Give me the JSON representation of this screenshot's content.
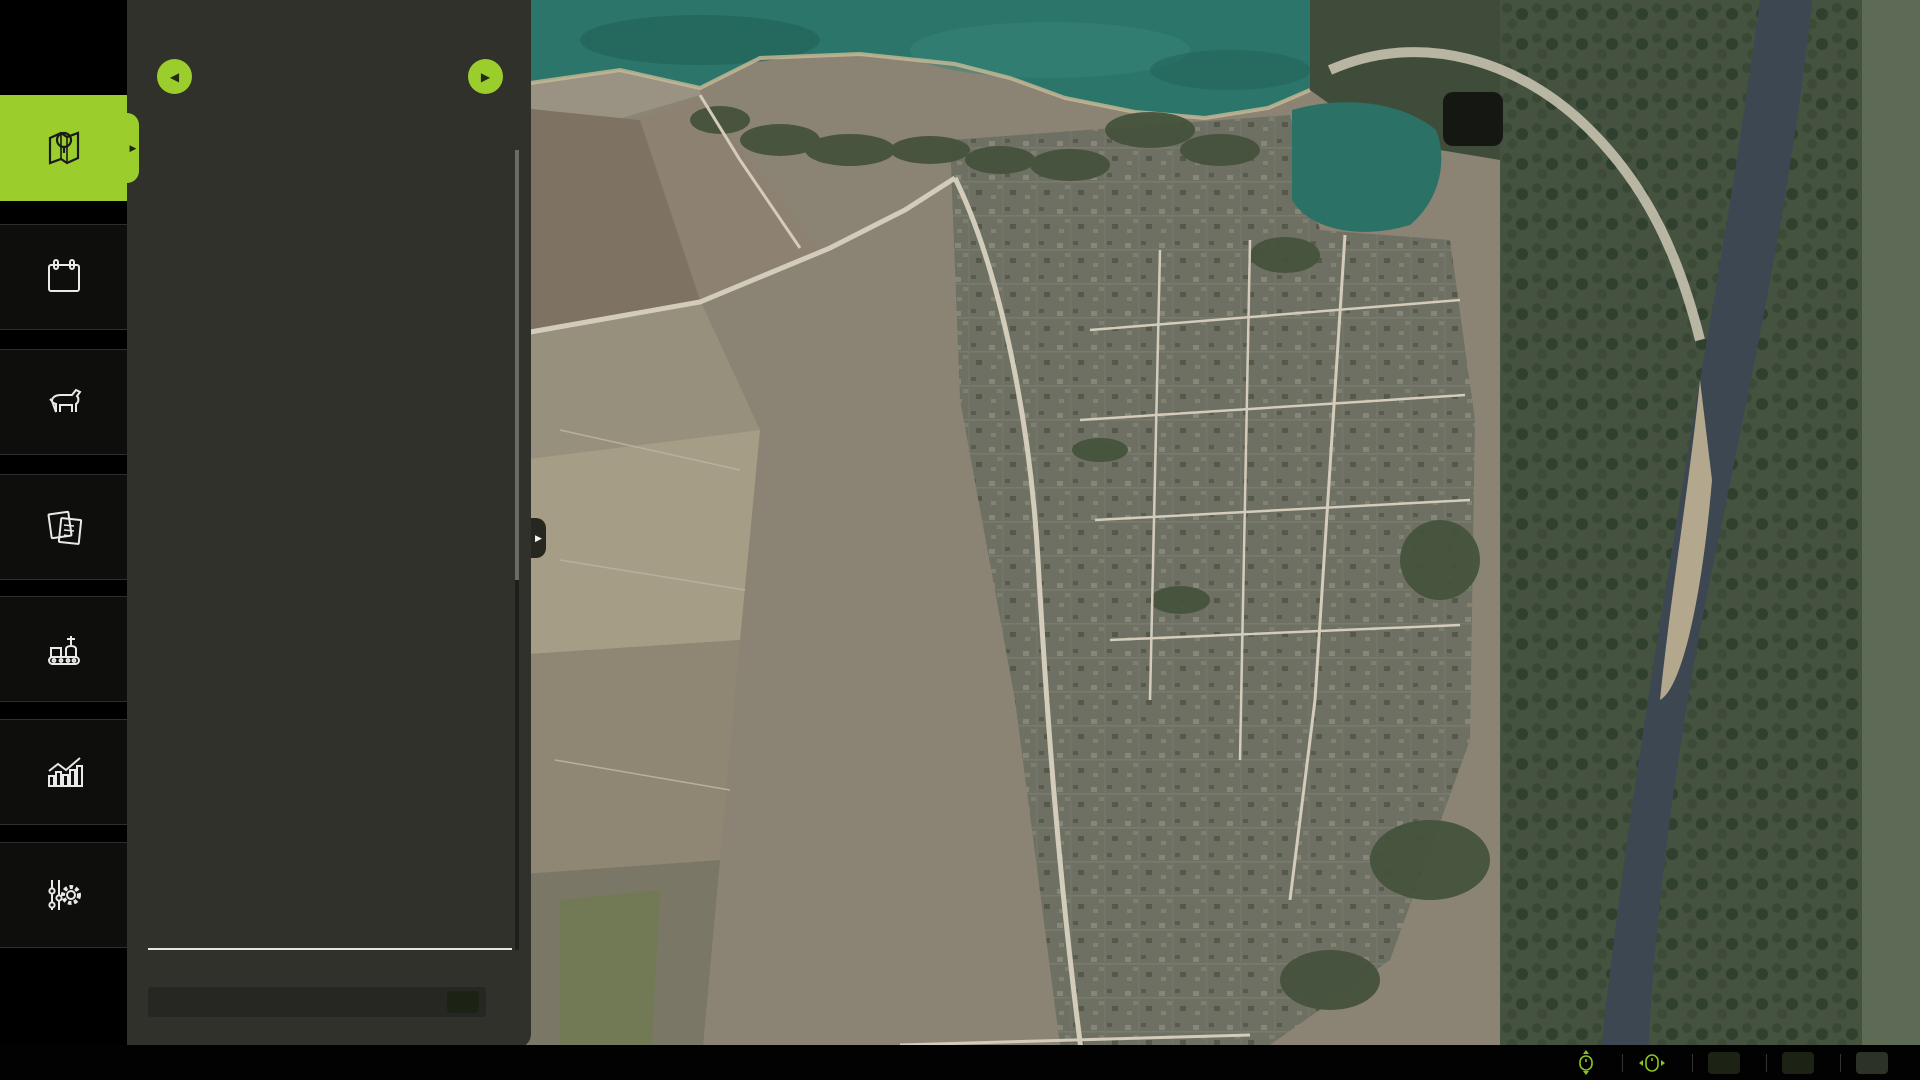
{
  "header": {
    "title": "CROP TYPES",
    "dots_total": 7,
    "dots_active": 0
  },
  "sidebar": {
    "items": [
      {
        "icon": "map-pin-icon",
        "selected": true
      },
      {
        "icon": "calendar-icon",
        "calendar_day": "15"
      },
      {
        "icon": "cow-icon"
      },
      {
        "icon": "contracts-icon"
      },
      {
        "icon": "production-icon"
      },
      {
        "icon": "statistics-icon"
      },
      {
        "icon": "settings-icon"
      }
    ]
  },
  "crops": [
    {
      "label": "WHEAT",
      "selected": true,
      "tile": "#121008",
      "head": "#d8a84e",
      "leaf": "#c69544"
    },
    {
      "label": "BARLEY",
      "tile": "#8d7a57",
      "head": "#e8d27e",
      "leaf": "#b99c54"
    },
    {
      "label": "CANOLA",
      "tile": "#9cc362",
      "head": "#f3d945",
      "leaf": "#55a548"
    },
    {
      "label": "OAT",
      "tile": "#c0763a",
      "head": "#ebdfb8",
      "leaf": "#d8c794"
    },
    {
      "label": "CORN",
      "tile": "#eda22f",
      "head": "#f2cf3a",
      "leaf": "#58a83a"
    },
    {
      "label": "SUNFLOWERS",
      "tile": "#e9c832",
      "head": "#6b4a1f",
      "leaf": "#f0cd28"
    },
    {
      "label": "SOYBEANS",
      "tile": "#9aa03c",
      "head": "#e6da6e",
      "leaf": "#7a9a2f"
    },
    {
      "label": "POTATOES",
      "tile": "#8a6a52",
      "head": "#b09a88",
      "leaf": "#8f7a68"
    },
    {
      "label": "RICE",
      "tile": "#f3eeb4",
      "head": "#9a8fa0",
      "leaf": "#5f9f4f"
    },
    {
      "label": "LONG GRAIN RICE",
      "tile": "#5a3a1c",
      "head": "#e8e0a8",
      "leaf": "#6faf5f"
    },
    {
      "label": "SUGAR BEET",
      "tile": "#e2a18d",
      "head": "#efe7d8",
      "leaf": "#4f8f3f"
    },
    {
      "label": "SUGARCANE",
      "tile": "#b3d288",
      "head": "#d8ecb4",
      "leaf": "#4f9f3f"
    },
    {
      "label": "COTTON",
      "tile": "#eee7e2",
      "head": "#ffffff",
      "leaf": "#9a7a5f"
    },
    {
      "label": "SORGHUM",
      "tile": "#b5773f",
      "head": "#c98a4a",
      "leaf": "#a86a35"
    },
    {
      "label": "GRAPES",
      "tile": "#7e82c8",
      "head": "#5a5eb5",
      "leaf": "#4a8f3f"
    },
    {
      "label": "OLIVES",
      "tile": "#9f7095",
      "head": "#6a8f4a",
      "leaf": "#44682c"
    }
  ],
  "deselect_all": {
    "label": "DESELECT ALL",
    "key": "W"
  },
  "balance": {
    "label": "BALANCE:",
    "value": "100,000 €",
    "value_color": "#a9d40b"
  },
  "bottom_bar": {
    "items": [
      {
        "icon": "mouse-scroll-icon",
        "label": "ZOOM MAP"
      },
      {
        "icon": "mouse-pan-icon",
        "label": "PAN MAP"
      },
      {
        "key": "A",
        "label": "PREVIOUS MENU"
      },
      {
        "key": "E",
        "label": "NEXT MENU"
      },
      {
        "key": "ESC",
        "label": "BACK"
      }
    ]
  },
  "map": {
    "highlighted_field": 14,
    "palette": {
      "tan": "#e6cf9c",
      "crimson": "#c40e63",
      "dkbrown": "#6b4423",
      "salmon": "#efac8e",
      "lime": "#97d02a",
      "yellow": "#ecc91f",
      "ltgreen": "#a4d45e",
      "sienna": "#b06f33",
      "gray": "#7b7166",
      "orange": "#ea6b24",
      "orange2": "#f1941f",
      "ltolive": "#a9c765",
      "brown": "#6f5843",
      "brown2": "#926b4d",
      "khaki": "#a28f4e",
      "olive": "#8f8f42",
      "seagreen": "#2fa06a",
      "cream": "#e4d2a8",
      "poi_rail": "#b011a0",
      "poi_fuel": "#2f55cc",
      "poi_person": "#e8c912",
      "poi_factory": "#16b8ab",
      "badge_bg": "#0b0b0b",
      "badge_hl": "#8a9a14"
    },
    "fields": [
      {
        "c": "tan",
        "p": "675,32 762,58 742,98 688,92 652,68"
      },
      {
        "c": "crimson",
        "p": "706,62 812,80 818,118 750,132 700,102"
      },
      {
        "c": "dkbrown",
        "p": "818,112 866,118 872,150 824,154"
      },
      {
        "c": "salmon",
        "p": "683,104 826,132 834,184 745,198 674,152"
      },
      {
        "c": "tan",
        "p": "884,196 906,190 904,234 883,238"
      },
      {
        "c": "lime",
        "p": "908,178 974,190 970,270 900,264 888,226"
      },
      {
        "c": "lime",
        "p": "986,160 1020,154 1024,190 990,194"
      },
      {
        "c": "crimson",
        "p": "874,246 964,256 960,352 920,356 896,346 868,300"
      },
      {
        "c": "yellow",
        "p": "740,238 780,242 778,302 700,306 700,284 738,278"
      },
      {
        "c": "tan",
        "p": "786,268 814,264 812,304 784,306"
      },
      {
        "c": "ltgreen",
        "p": "788,308 854,302 850,330 790,332"
      },
      {
        "c": "tan",
        "p": "788,334 852,330 850,372 788,374"
      },
      {
        "c": "salmon",
        "p": "698,310 778,308 776,352 696,354"
      },
      {
        "c": "lime",
        "p": "698,358 800,362 796,558 704,552"
      },
      {
        "c": "tan",
        "p": "806,364 870,368 866,508 802,504"
      },
      {
        "c": "sienna",
        "p": "876,368 938,372 934,508 872,504"
      },
      {
        "c": "salmon",
        "p": "942,374 996,378 992,468 940,464"
      },
      {
        "c": "gray",
        "p": "940,470 990,472 987,510 938,508"
      },
      {
        "c": "gray",
        "p": "937,514 987,516 984,562 935,560"
      },
      {
        "c": "gray",
        "p": "935,566 984,568 982,612 933,610"
      },
      {
        "c": "orange2",
        "p": "806,514 878,517 874,606 802,602"
      },
      {
        "c": "yellow",
        "p": "886,516 932,518 928,614 882,610"
      },
      {
        "c": "crimson",
        "p": "996,540 1060,543 1058,612 1038,612 1038,582 1016,580 1014,610 996,608"
      },
      {
        "c": "ltolive",
        "p": "686,556 882,564 878,732 700,726 680,642"
      },
      {
        "c": "brown",
        "p": "886,622 926,624 922,747 884,744"
      },
      {
        "c": "gray",
        "p": "998,650 1094,652 1090,712 1034,714 998,692"
      },
      {
        "c": "tan",
        "p": "998,660 1050,702 1048,758 996,754"
      },
      {
        "c": "gray",
        "p": "1054,718 1094,716 1092,760 1052,762"
      },
      {
        "c": "lime",
        "p": "692,708 847,712 842,802 690,798"
      },
      {
        "c": "cream",
        "p": "850,754 932,750 928,802 846,804"
      },
      {
        "c": "orange",
        "p": "688,802 882,800 878,847 686,850"
      },
      {
        "c": "orange",
        "p": "688,854 907,850 902,1014 686,1010"
      },
      {
        "c": "gray",
        "p": "908,762 1050,758 1046,814 905,817"
      },
      {
        "c": "yellow",
        "p": "1120,708 1244,702 1240,774 1118,777"
      },
      {
        "c": "salmon",
        "p": "1040,822 1247,814 1242,867 1036,870"
      },
      {
        "c": "brown2",
        "p": "928,860 1002,857 998,902 925,904"
      },
      {
        "c": "sienna",
        "p": "928,910 1020,907 1016,1002 925,1004"
      },
      {
        "c": "gray",
        "p": "1042,877 1252,872 1247,947 1122,950 1120,917 1040,920"
      },
      {
        "c": "khaki",
        "p": "1042,924 1117,922 1120,954 1250,950 1246,1002 1040,1004"
      },
      {
        "c": "sienna",
        "p": "1062,1010 1252,1004 1250,1032 1060,1034"
      },
      {
        "c": "salmon",
        "p": "1262,714 1332,707 1328,784 1258,787"
      },
      {
        "c": "crimson",
        "p": "1334,670 1430,664 1426,742 1330,746"
      },
      {
        "c": "olive",
        "p": "1251,779 1294,776 1290,814 1247,817"
      },
      {
        "c": "olive",
        "p": "1297,776 1347,773 1344,812 1294,814"
      },
      {
        "c": "yellow",
        "p": "1251,822 1312,818 1308,880 1246,882"
      },
      {
        "c": "orange",
        "p": "1480,470 1504,462 1512,560 1492,622 1474,560"
      },
      {
        "c": "seagreen",
        "p": "1382,22 1442,16 1454,72 1422,97 1384,72"
      },
      {
        "c": "orange2",
        "p": "962,352 997,347 994,384 960,387"
      },
      {
        "c": "crimson",
        "p": "1190,410 1224,407 1222,440 1188,442"
      },
      {
        "c": "lime",
        "p": "1188,472 1214,470 1212,496 1186,498"
      },
      {
        "c": "crimson",
        "p": "1096,502 1120,500 1118,524 1094,526"
      },
      {
        "c": "crimson",
        "p": "1092,628 1112,626 1110,646 1090,648"
      },
      {
        "c": "crimson",
        "p": "1112,642 1132,640 1130,660 1110,662"
      },
      {
        "c": "crimson",
        "p": "1098,560 1118,558 1116,578 1096,580"
      }
    ],
    "badges": [
      [
        1,
        1151,
        1013
      ],
      [
        2,
        1129,
        978
      ],
      [
        3,
        1161,
        910
      ],
      [
        4,
        1002,
        955
      ],
      [
        5,
        1007,
        875
      ],
      [
        6,
        828,
        920
      ],
      [
        7,
        1134,
        841
      ],
      [
        8,
        1051,
        789
      ],
      [
        9,
        1179,
        737
      ],
      [
        10,
        1271,
        845
      ],
      [
        11,
        1270,
        791
      ],
      [
        12,
        1312,
        791
      ],
      [
        13,
        1288,
        744
      ],
      [
        14,
        1352,
        721
      ],
      [
        15,
        1319,
        714
      ],
      [
        16,
        1068,
        736
      ],
      [
        17,
        1018,
        714
      ],
      [
        18,
        1053,
        667
      ],
      [
        19,
        793,
        820
      ],
      [
        20,
        928,
        774
      ],
      [
        21,
        780,
        758
      ],
      [
        22,
        904,
        689
      ],
      [
        23,
        802,
        666
      ],
      [
        24,
        906,
        558
      ],
      [
        25,
        836,
        555
      ],
      [
        26,
        758,
        453
      ],
      [
        27,
        839,
        438
      ],
      [
        28,
        909,
        440
      ],
      [
        29,
        964,
        484
      ],
      [
        30,
        966,
        427
      ],
      [
        31,
        846,
        339
      ],
      [
        32,
        840,
        314
      ],
      [
        33,
        813,
        291
      ],
      [
        34,
        776,
        279
      ],
      [
        35,
        765,
        327
      ],
      [
        36,
        770,
        156
      ],
      [
        37,
        773,
        93
      ],
      [
        38,
        845,
        127
      ],
      [
        39,
        943,
        216
      ],
      [
        40,
        920,
        289
      ],
      [
        41,
        900,
        197
      ],
      [
        42,
        1414,
        55
      ],
      [
        43,
        1491,
        549
      ],
      [
        44,
        1030,
        566
      ],
      [
        45,
        1002,
        176
      ],
      [
        46,
        721,
        60
      ],
      [
        47,
        976,
        364
      ],
      [
        48,
        1198,
        482
      ],
      [
        49,
        1217,
        487
      ],
      [
        50,
        1123,
        420
      ],
      [
        51,
        1202,
        425
      ],
      [
        52,
        1093,
        624
      ],
      [
        53,
        1108,
        637
      ],
      [
        54,
        1197,
        682
      ],
      [
        55,
        1218,
        639
      ],
      [
        56,
        1105,
        558
      ],
      [
        57,
        1107,
        599
      ],
      [
        58,
        1103,
        515
      ],
      [
        59,
        1357,
        202
      ],
      [
        60,
        1328,
        192
      ],
      [
        61,
        1352,
        88
      ],
      [
        62,
        1338,
        72
      ],
      [
        63,
        1351,
        40
      ],
      [
        64,
        1446,
        315
      ],
      [
        66,
        1067,
        223
      ],
      [
        67,
        1072,
        327
      ],
      [
        68,
        1015,
        218
      ],
      [
        69,
        943,
        140
      ],
      [
        70,
        1198,
        342
      ],
      [
        71,
        1253,
        271
      ],
      [
        72,
        1309,
        366
      ],
      [
        73,
        1637,
        72
      ],
      [
        74,
        1338,
        303
      ],
      [
        75,
        1644,
        251
      ],
      [
        76,
        1293,
        597
      ],
      [
        77,
        1368,
        612
      ],
      [
        78,
        1613,
        385
      ],
      [
        79,
        1623,
        487
      ],
      [
        80,
        1403,
        510
      ],
      [
        81,
        1375,
        477
      ],
      [
        82,
        1417,
        402
      ],
      [
        83,
        1630,
        583
      ],
      [
        84,
        1638,
        652
      ],
      [
        86,
        1480,
        856
      ],
      [
        87,
        1598,
        888
      ],
      [
        88,
        1270,
        999
      ],
      [
        89,
        1356,
        905
      ],
      [
        91,
        1373,
        159
      ],
      [
        92,
        1370,
        256
      ],
      [
        93,
        1428,
        173
      ],
      [
        94,
        1489,
        195
      ],
      [
        95,
        1255,
        21
      ],
      [
        96,
        1452,
        280
      ],
      [
        97,
        1143,
        298
      ],
      [
        98,
        1357,
        397
      ],
      [
        99,
        1127,
        355
      ],
      [
        100,
        1378,
        333
      ]
    ],
    "pois": [
      {
        "t": "rail",
        "x": 937,
        "y": 100
      },
      {
        "t": "rail",
        "x": 925,
        "y": 118
      },
      {
        "t": "rail",
        "x": 947,
        "y": 124
      },
      {
        "t": "rail",
        "x": 1112,
        "y": 169
      },
      {
        "t": "rail",
        "x": 1350,
        "y": 172
      },
      {
        "t": "rail",
        "x": 1388,
        "y": 208
      },
      {
        "t": "person",
        "x": 1420,
        "y": 205
      },
      {
        "t": "rail",
        "x": 1431,
        "y": 218
      },
      {
        "t": "down",
        "x": 1412,
        "y": 180
      },
      {
        "t": "down",
        "x": 1375,
        "y": 282
      },
      {
        "t": "fuel",
        "x": 1383,
        "y": 300
      },
      {
        "t": "down",
        "x": 1405,
        "y": 305
      },
      {
        "t": "person",
        "x": 1415,
        "y": 328
      },
      {
        "t": "down",
        "x": 1438,
        "y": 330
      },
      {
        "t": "person",
        "x": 1423,
        "y": 363
      },
      {
        "t": "down",
        "x": 1440,
        "y": 365
      },
      {
        "t": "rail",
        "x": 1431,
        "y": 395
      },
      {
        "t": "rail",
        "x": 1403,
        "y": 413
      },
      {
        "t": "fuel",
        "x": 1408,
        "y": 436
      },
      {
        "t": "person",
        "x": 1376,
        "y": 506
      },
      {
        "t": "fuel",
        "x": 1358,
        "y": 516
      },
      {
        "t": "down",
        "x": 1068,
        "y": 377
      },
      {
        "t": "rail",
        "x": 1086,
        "y": 375
      },
      {
        "t": "fuel",
        "x": 1107,
        "y": 378
      },
      {
        "t": "rail",
        "x": 1238,
        "y": 438
      },
      {
        "t": "factory",
        "x": 1240,
        "y": 490
      },
      {
        "t": "down",
        "x": 1223,
        "y": 512
      },
      {
        "t": "home",
        "x": 1262,
        "y": 537
      },
      {
        "t": "down",
        "x": 1203,
        "y": 560
      },
      {
        "t": "down",
        "x": 1227,
        "y": 557
      },
      {
        "t": "rail",
        "x": 1240,
        "y": 580
      },
      {
        "t": "rail",
        "x": 1258,
        "y": 571
      },
      {
        "t": "down",
        "x": 1243,
        "y": 602
      },
      {
        "t": "rail",
        "x": 1322,
        "y": 593
      },
      {
        "t": "rail",
        "x": 1342,
        "y": 588
      },
      {
        "t": "down",
        "x": 1372,
        "y": 585
      },
      {
        "t": "rail",
        "x": 1320,
        "y": 660
      },
      {
        "t": "rail",
        "x": 1355,
        "y": 662
      },
      {
        "t": "person",
        "x": 1275,
        "y": 668
      },
      {
        "t": "person",
        "x": 1284,
        "y": 680
      },
      {
        "t": "down",
        "x": 1565,
        "y": 784
      }
    ],
    "cursor": {
      "x": 925,
      "y": 77
    }
  }
}
